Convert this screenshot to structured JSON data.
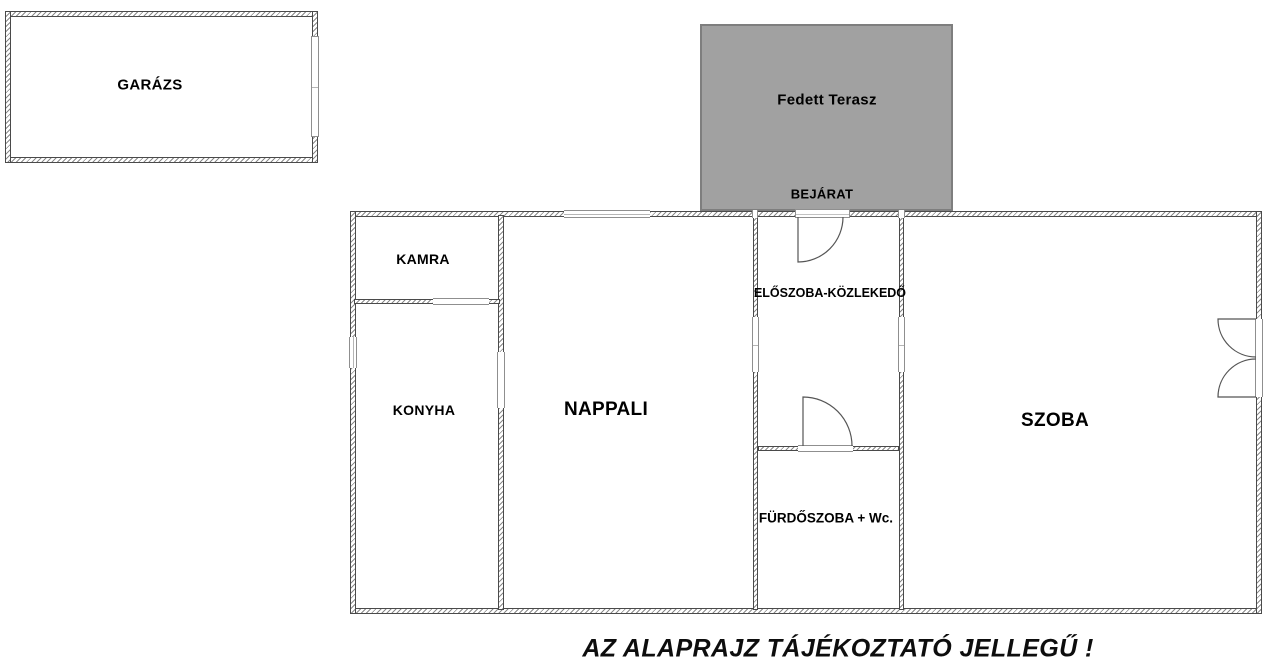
{
  "rooms": {
    "garage": {
      "label": "GARÁZS"
    },
    "terrace": {
      "label": "Fedett Terasz"
    },
    "entrance": {
      "label": "BEJÁRAT"
    },
    "pantry": {
      "label": "KAMRA"
    },
    "hallway": {
      "label": "ELŐSZOBA-KÖZLEKEDŐ"
    },
    "kitchen": {
      "label": "KONYHA"
    },
    "living": {
      "label": "NAPPALI"
    },
    "room": {
      "label": "SZOBA"
    },
    "bathroom": {
      "label": "FÜRDŐSZOBA + Wc."
    }
  },
  "caption": "AZ ALAPRAJZ TÁJÉKOZTATÓ JELLEGŰ !",
  "colors": {
    "terrace_fill": "#a1a1a1",
    "terrace_border": "#7e7e7e",
    "wall_outline": "#4a4a4a",
    "hatch_line": "#8a8a8a",
    "door_line": "#555555",
    "label_text": "#000000"
  }
}
